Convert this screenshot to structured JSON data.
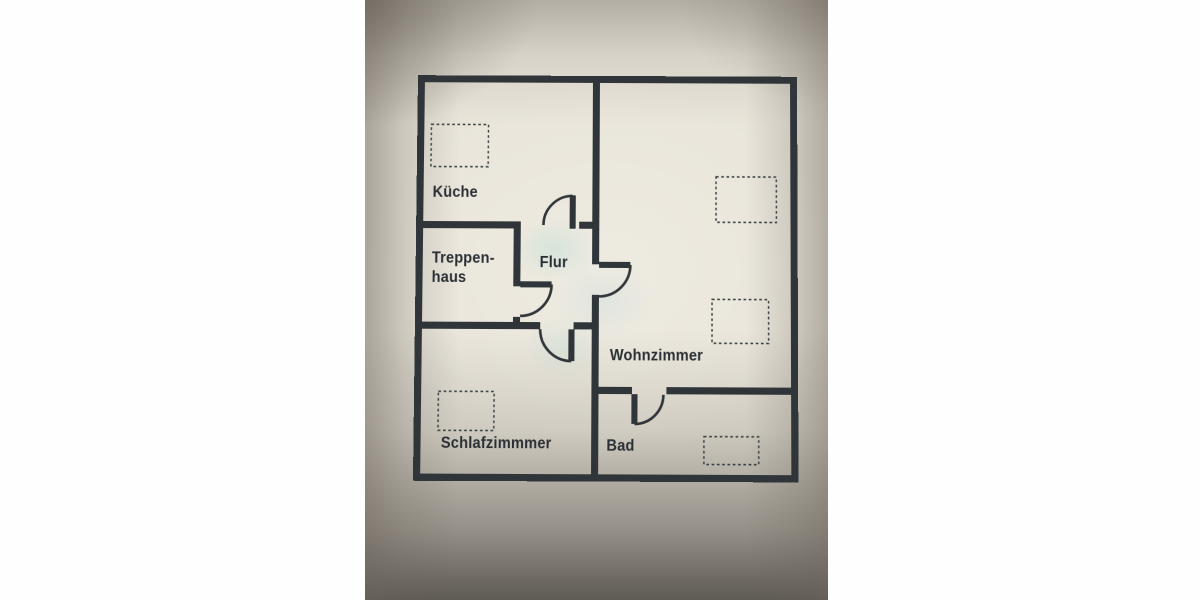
{
  "document": {
    "kind": "apartment-floor-plan-photo",
    "language": "de"
  },
  "rooms": {
    "kitchen": {
      "label": "Küche"
    },
    "stairwell": {
      "label_line1": "Treppen-",
      "label_line2": "haus"
    },
    "hallway": {
      "label": "Flur"
    },
    "living_room": {
      "label": "Wohnzimmer"
    },
    "bedroom": {
      "label": "Schlafzimmmer"
    },
    "bathroom": {
      "label": "Bad"
    }
  },
  "symbols": {
    "door_swing": "quarter-circle-arc-with-leaf",
    "fixture_outline": "dashed-rectangle"
  },
  "colors": {
    "wall": "#30353a",
    "paper": "#e9e5da",
    "label_text": "#2a2f34",
    "bezel_taupe": "#a9a29a",
    "page_margin": "#ffffff"
  }
}
